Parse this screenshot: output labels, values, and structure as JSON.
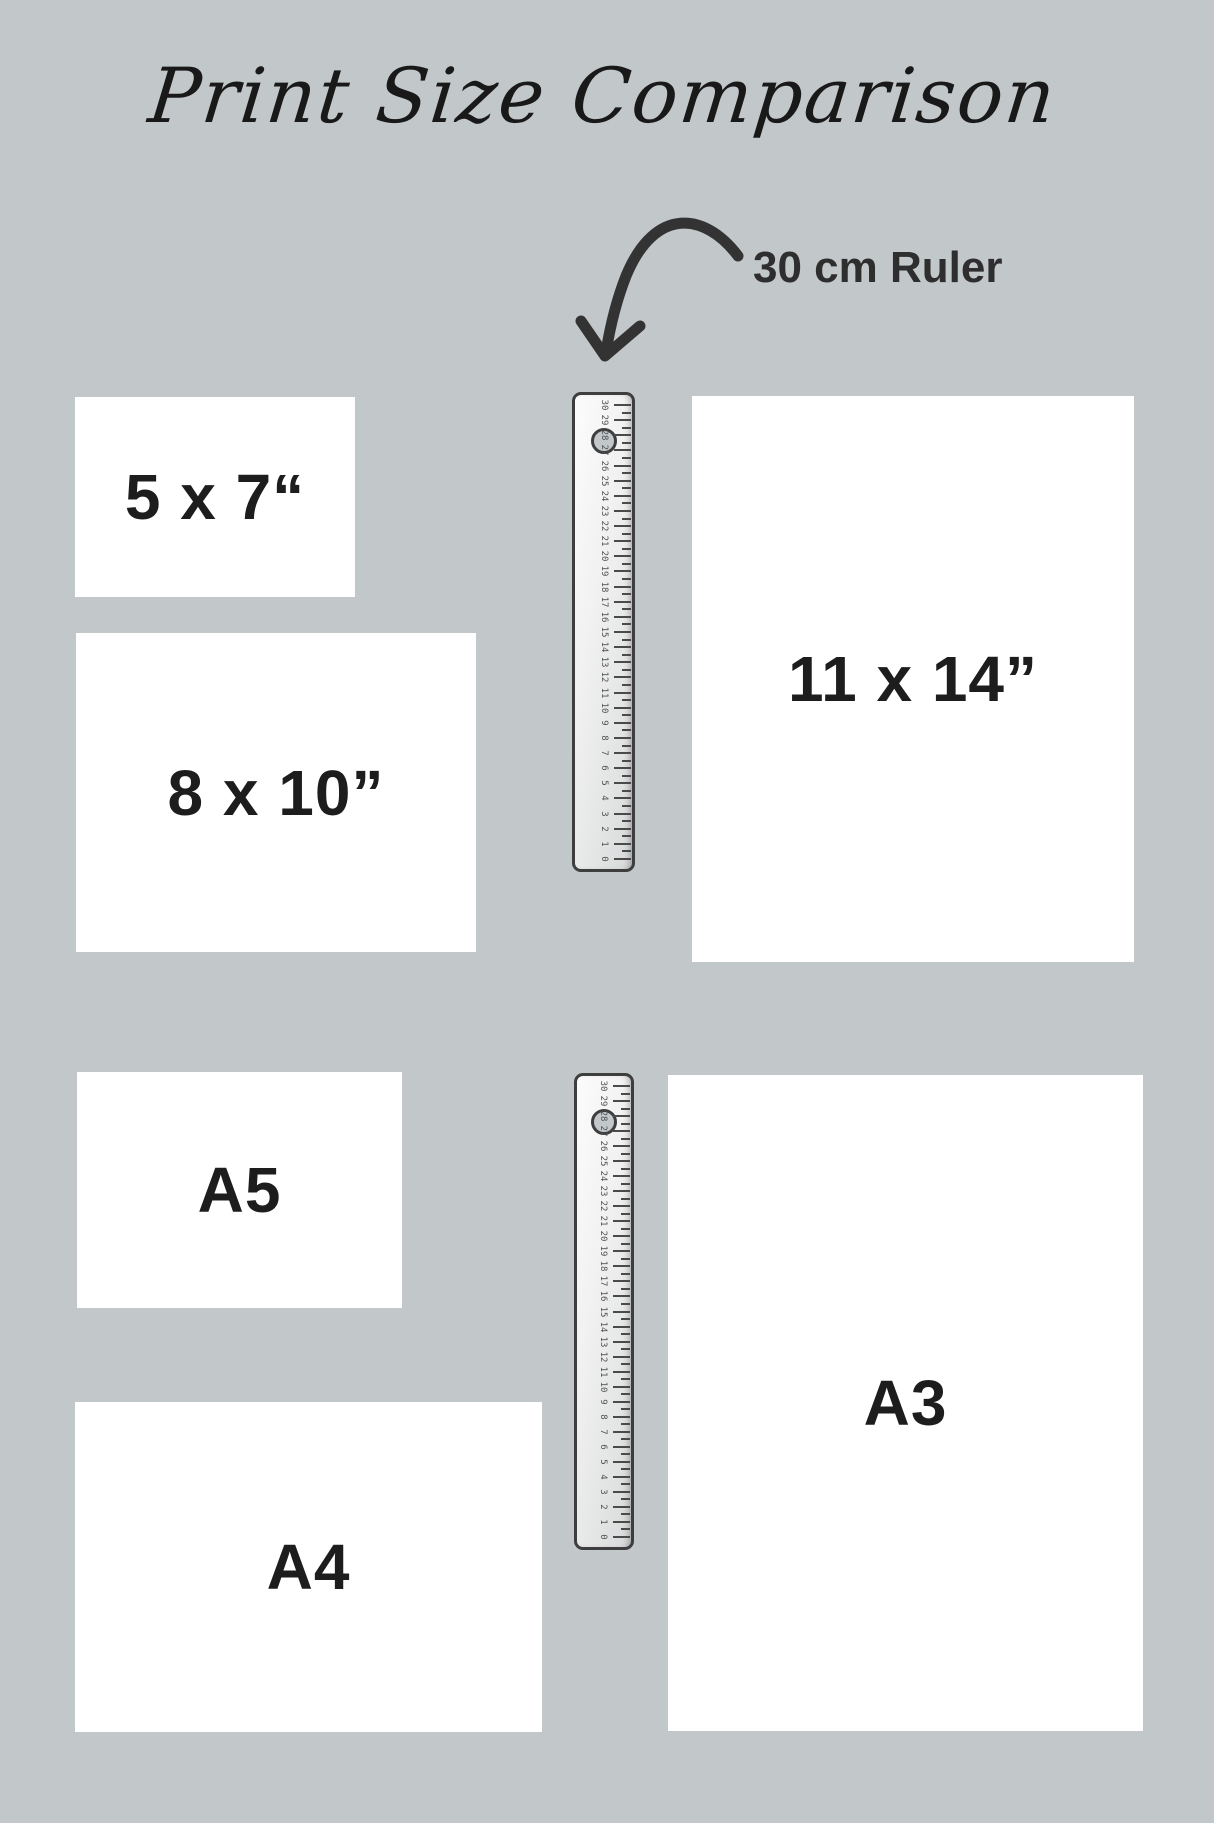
{
  "title": "Print Size Comparison",
  "annotation": {
    "label": "30 cm Ruler"
  },
  "colors": {
    "background": "#c2c7ca",
    "label_text": "#1d1d1d",
    "annotation_text": "#2e2e2e",
    "arrow": "#333333",
    "ruler_border": "#3e3e3e",
    "tick": "#4a4a4a",
    "tick_number": "#4f5254",
    "print_fill": "#ffffff"
  },
  "prints": [
    {
      "id": "5x7",
      "label": "5 x 7“",
      "x": 75,
      "y": 397,
      "w": 280,
      "h": 200
    },
    {
      "id": "8x10",
      "label": "8 x 10”",
      "x": 76,
      "y": 633,
      "w": 400,
      "h": 319
    },
    {
      "id": "11x14",
      "label": "11 x 14”",
      "x": 692,
      "y": 396,
      "w": 442,
      "h": 566
    },
    {
      "id": "a5",
      "label": "A5",
      "x": 77,
      "y": 1072,
      "w": 325,
      "h": 236
    },
    {
      "id": "a4",
      "label": "A4",
      "x": 75,
      "y": 1402,
      "w": 467,
      "h": 330
    },
    {
      "id": "a3",
      "label": "A3",
      "x": 668,
      "y": 1075,
      "w": 475,
      "h": 656
    }
  ],
  "rulers": [
    {
      "id": "ruler-top",
      "x": 572,
      "y": 392,
      "w": 63,
      "h": 480,
      "min": 0,
      "max": 30,
      "unit": "cm"
    },
    {
      "id": "ruler-bottom",
      "x": 574,
      "y": 1073,
      "w": 60,
      "h": 477,
      "min": 0,
      "max": 30,
      "unit": "cm"
    }
  ]
}
